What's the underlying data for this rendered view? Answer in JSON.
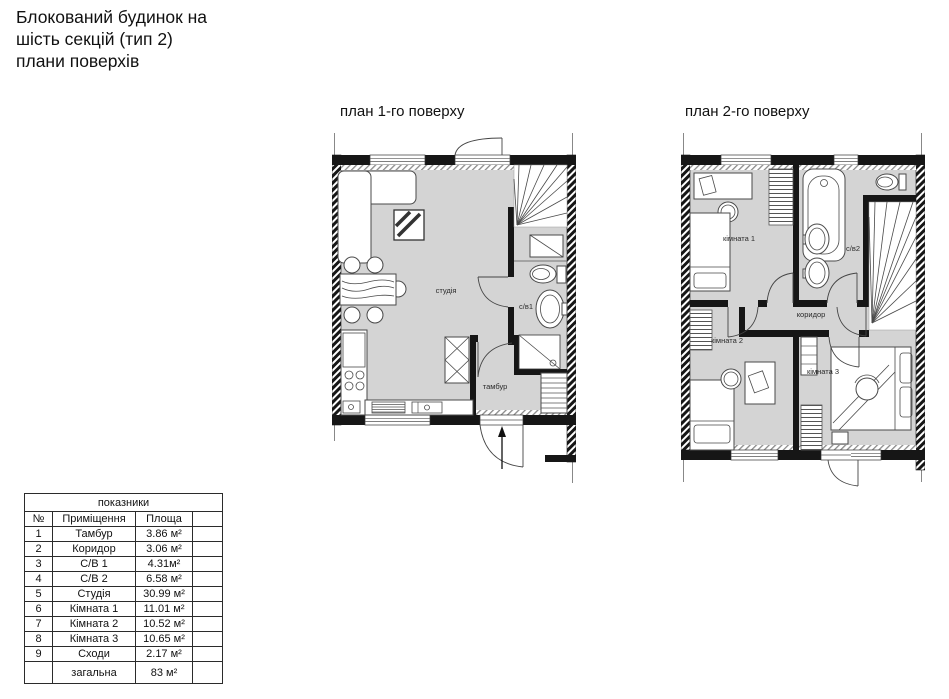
{
  "title": {
    "lines": [
      "Блокований будинок на",
      "шість секцій (тип 2)",
      "плани поверхів"
    ]
  },
  "floor1": {
    "label": "план 1-го поверху",
    "rooms": {
      "studio": "студія",
      "bath1": "с/в1",
      "vestibule": "тамбур"
    }
  },
  "floor2": {
    "label": "план 2-го поверху",
    "rooms": {
      "room1": "кімната 1",
      "bath2": "с/в2",
      "corridor": "коридор",
      "room2": "кімната 2",
      "room3": "кімната 3"
    }
  },
  "table": {
    "title": "показники",
    "headers": {
      "num": "№",
      "room": "Приміщення",
      "area": "Площа"
    },
    "rows": [
      {
        "num": "1",
        "room": "Тамбур",
        "area": "3.86 м²"
      },
      {
        "num": "2",
        "room": "Коридор",
        "area": "3.06 м²"
      },
      {
        "num": "3",
        "room": "С/В 1",
        "area": "4.31м²"
      },
      {
        "num": "4",
        "room": "С/В 2",
        "area": "6.58 м²"
      },
      {
        "num": "5",
        "room": "Студія",
        "area": "30.99 м²"
      },
      {
        "num": "6",
        "room": "Кімната 1",
        "area": "11.01 м²"
      },
      {
        "num": "7",
        "room": "Кімната 2",
        "area": "10.52 м²"
      },
      {
        "num": "8",
        "room": "Кімната 3",
        "area": "10.65 м²"
      },
      {
        "num": "9",
        "room": "Сходи",
        "area": "2.17 м²"
      }
    ],
    "total": {
      "label": "загальна",
      "area": "83 м²"
    }
  },
  "colors": {
    "wall": "#161616",
    "floor": "#d4d4d4",
    "furniture_line": "#4a4a4a"
  }
}
